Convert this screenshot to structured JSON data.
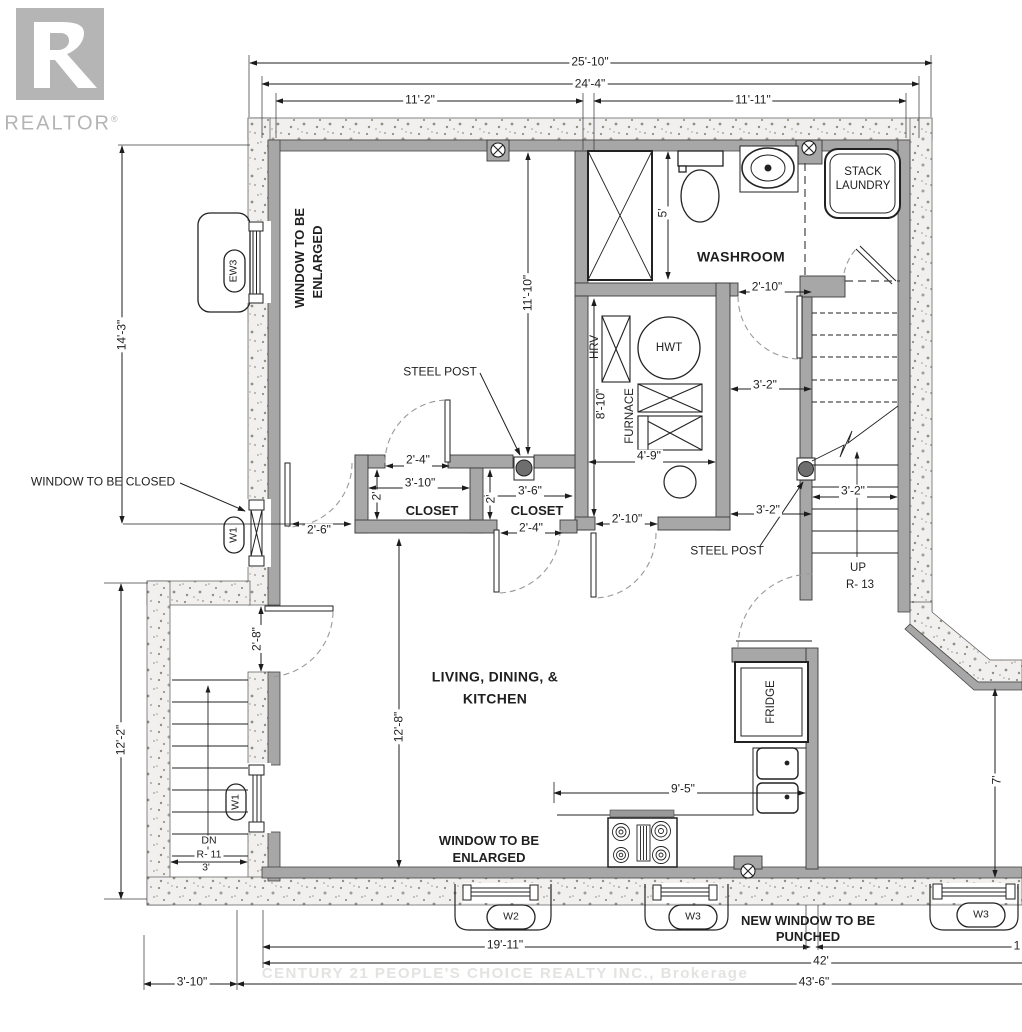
{
  "logo": {
    "brand": "REALTOR",
    "registered": "®"
  },
  "watermark": "CENTURY 21 PEOPLE'S CHOICE REALTY INC., Brokerage",
  "rooms": {
    "washroom": "WASHROOM",
    "living_line1": "LIVING, DINING, &",
    "living_line2": "KITCHEN",
    "closet": "CLOSET"
  },
  "equipment": {
    "stack_line1": "STACK",
    "stack_line2": "LAUNDRY",
    "hrv": "HRV",
    "hwt": "HWT",
    "furnace": "FURNACE",
    "fridge": "FRIDGE"
  },
  "stairs": {
    "up": "UP",
    "up_risers": "R- 13",
    "down": "DN",
    "down_risers": "R- 11"
  },
  "annotations": {
    "window_enlarged_line1": "WINDOW TO BE",
    "window_enlarged_line2": "ENLARGED",
    "window_closed": "WINDOW TO BE CLOSED",
    "new_window_line1": "NEW WINDOW TO BE",
    "new_window_line2": "PUNCHED",
    "steel_post": "STEEL POST"
  },
  "window_tags": {
    "ew3": "EW3",
    "w1": "W1",
    "w2": "W2",
    "w3": "W3"
  },
  "dims": {
    "overall_width": "25'-10\"",
    "inner_width": "24'-4\"",
    "left_span": "11'-2\"",
    "right_span": "11'-11\"",
    "left_height_upper": "14'-3\"",
    "open_area_height": "11'-10\"",
    "shower": "5'",
    "washroom_door": "2'-10\"",
    "mech_height": "8'-10\"",
    "mech_width": "4'-9\"",
    "mech_door": "2'-10\"",
    "closet_left_door": "2'-4\"",
    "closet_left_width": "3'-10\"",
    "closet_depth": "2'",
    "closet_right_width": "3'-6\"",
    "closet_right_door": "2'-4\"",
    "passage": "2'-6\"",
    "hall_upper": "3'-2\"",
    "hall_lower": "3'-2\"",
    "stair_width": "3'-2\"",
    "entry_door": "2'-8\"",
    "left_height_lower": "12'-2\"",
    "living_height": "12'-8\"",
    "counter_run": "9'-5\"",
    "stair_left_width": "3'",
    "right_setback": "7'",
    "window_run": "19'-11\"",
    "total_42": "42'",
    "total_43": "43'-6\"",
    "bumpout_depth": "3'-10\"",
    "partial_right": "1"
  },
  "colors": {
    "wall_gray": "#a7a7a7",
    "concrete": "#f1f0ee",
    "logo_gray": "#b5b5b5",
    "watermark_gray": "#e3e3e1"
  }
}
